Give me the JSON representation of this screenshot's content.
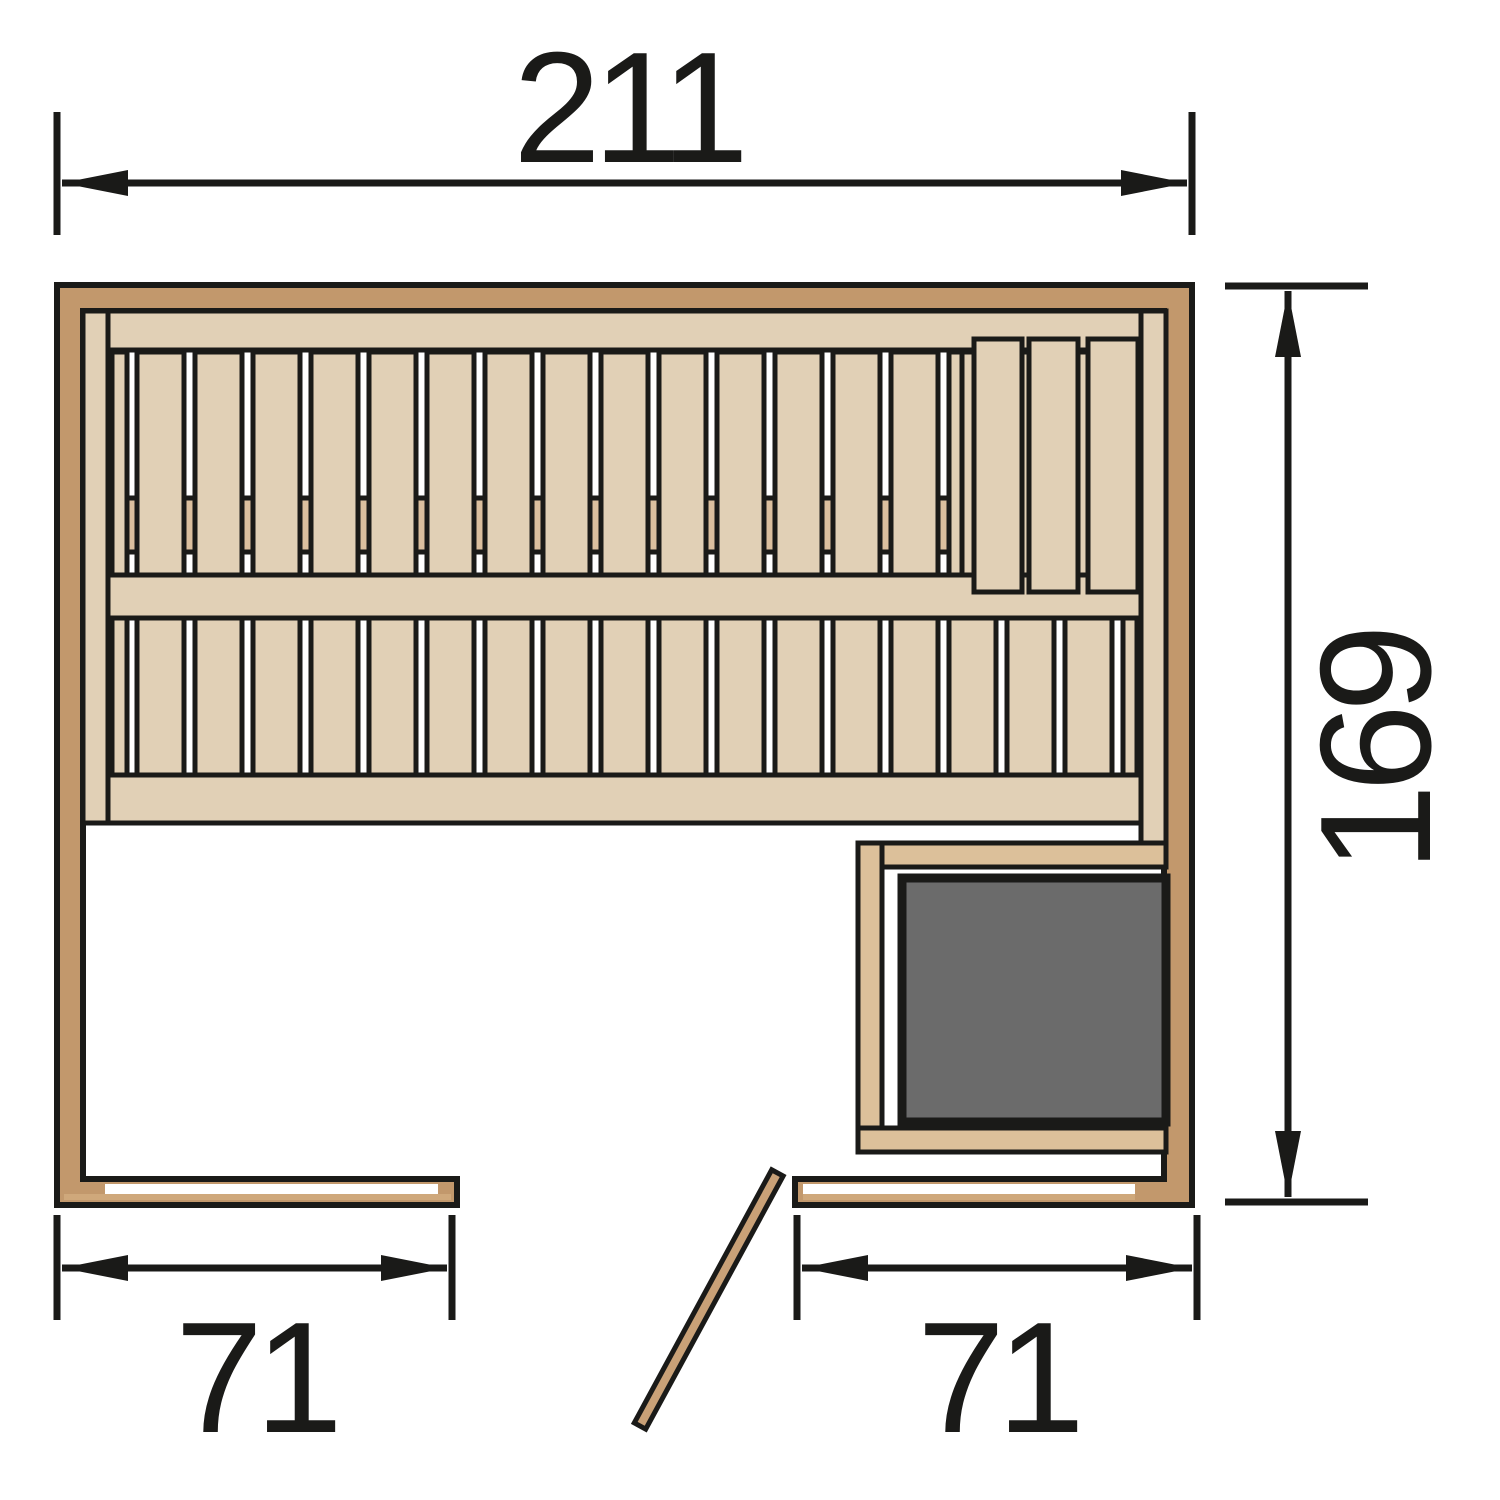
{
  "diagram": {
    "type": "sauna-floor-plan-top-view",
    "dimensions": {
      "width_label": "211",
      "depth_label": "169",
      "left_wall_label": "71",
      "right_wall_label": "71"
    },
    "colors": {
      "bg": "#ffffff",
      "line": "#1a1a18",
      "wall": "#c2986c",
      "bench": "#e1d0b6",
      "support": "#dbbf9e",
      "guard": "#dcc09a",
      "heater": "#6b6b6b",
      "door": "#c9a177",
      "lining": "#ffffff",
      "strip": "#cfa87b"
    },
    "plan": {
      "upper_bench_slats": {
        "x0": 112,
        "x1": 962,
        "y": 352,
        "h": 223,
        "narrow_w": 15,
        "narrow_gap": 10,
        "slat_w": 47,
        "gap": 11
      },
      "lower_bench_slats": {
        "x0": 112,
        "x1": 1137,
        "y": 618,
        "h": 157,
        "narrow_w": 15,
        "narrow_gap": 10,
        "slat_w": 47,
        "gap": 11
      },
      "backrest_board_count": 3
    }
  }
}
